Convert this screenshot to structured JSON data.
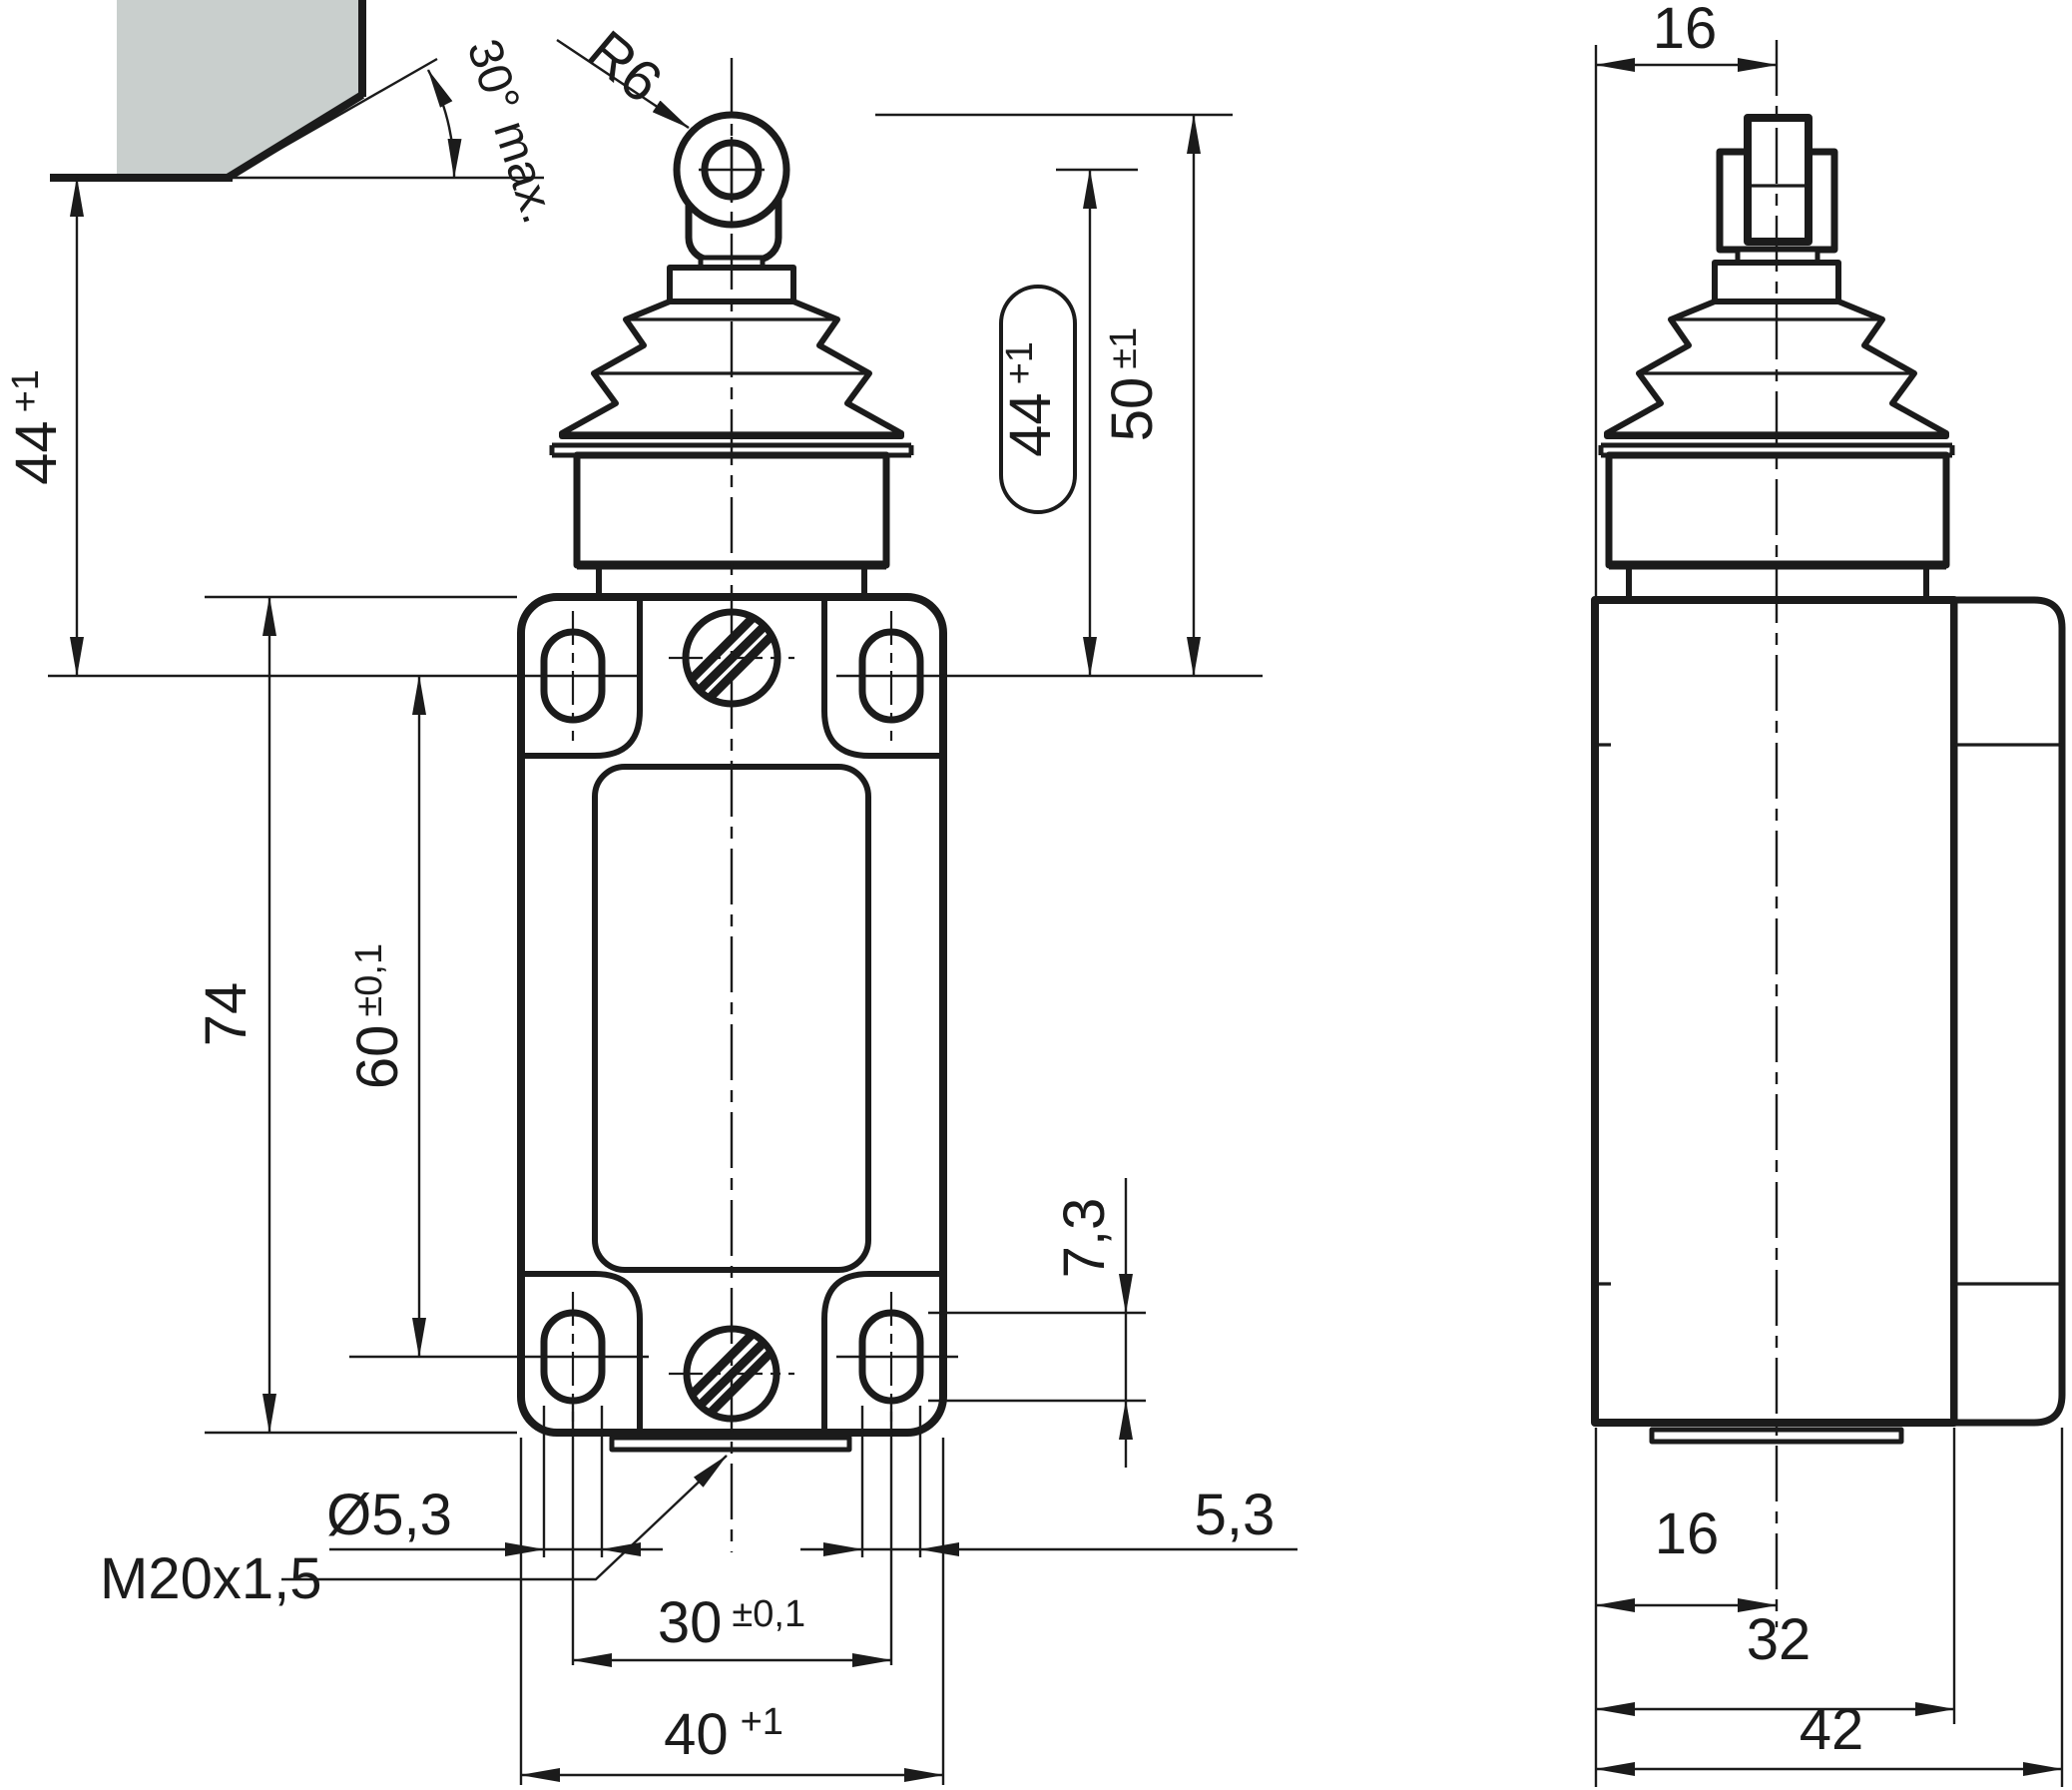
{
  "drawing": {
    "colors": {
      "line": "#1b1b1b",
      "fill": "#c9cfcd",
      "background": "#ffffff"
    },
    "front_view": {
      "approach_angle": "30° max.",
      "roller_radius": "R6",
      "free_height": {
        "value": "44",
        "tol": "+1"
      },
      "stroke_capsule": {
        "value": "44",
        "tol": "+1"
      },
      "operating_height": {
        "value": "50",
        "tol": "±1"
      },
      "body_height": "74",
      "hole_spacing_vertical": {
        "value": "60",
        "tol": "±0,1"
      },
      "slot_length": "7,3",
      "hole_diameter": "Ø5,3",
      "cable_entry_thread": "M20x1,5",
      "slot_width": "5,3",
      "hole_spacing_horizontal": {
        "value": "30",
        "tol": "±0,1"
      },
      "body_width": {
        "value": "40",
        "tol": "+1"
      }
    },
    "side_view": {
      "top_width": "16",
      "bottom_offset": "16",
      "body_depth": "32",
      "total_depth": "42"
    }
  }
}
